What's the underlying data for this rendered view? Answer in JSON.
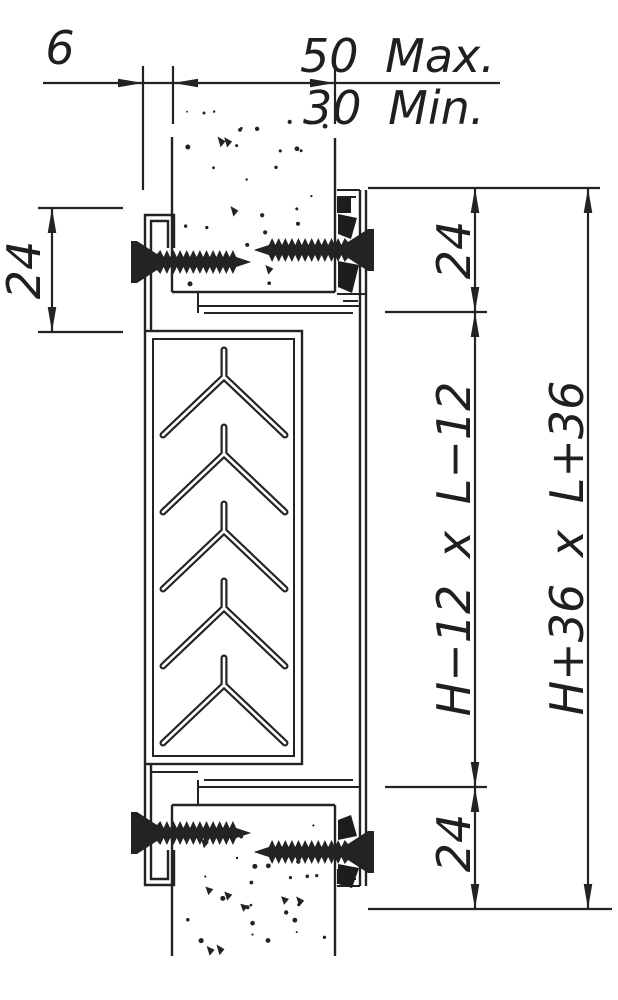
{
  "drawing": {
    "description": "Wall-mounted transfer grille cross-section",
    "colors": {
      "ink": "#232323",
      "background": "#ffffff"
    },
    "dimensions": {
      "top": {
        "frame_gap": "6",
        "wall_max": "50 Max.",
        "wall_min": "30 Min."
      },
      "left": {
        "frame_depth": "24"
      },
      "right": {
        "top_margin": "24",
        "opening_size": "H−12 x L−12",
        "bottom_margin": "24",
        "overall_size": "H+36 x L+36"
      }
    }
  }
}
